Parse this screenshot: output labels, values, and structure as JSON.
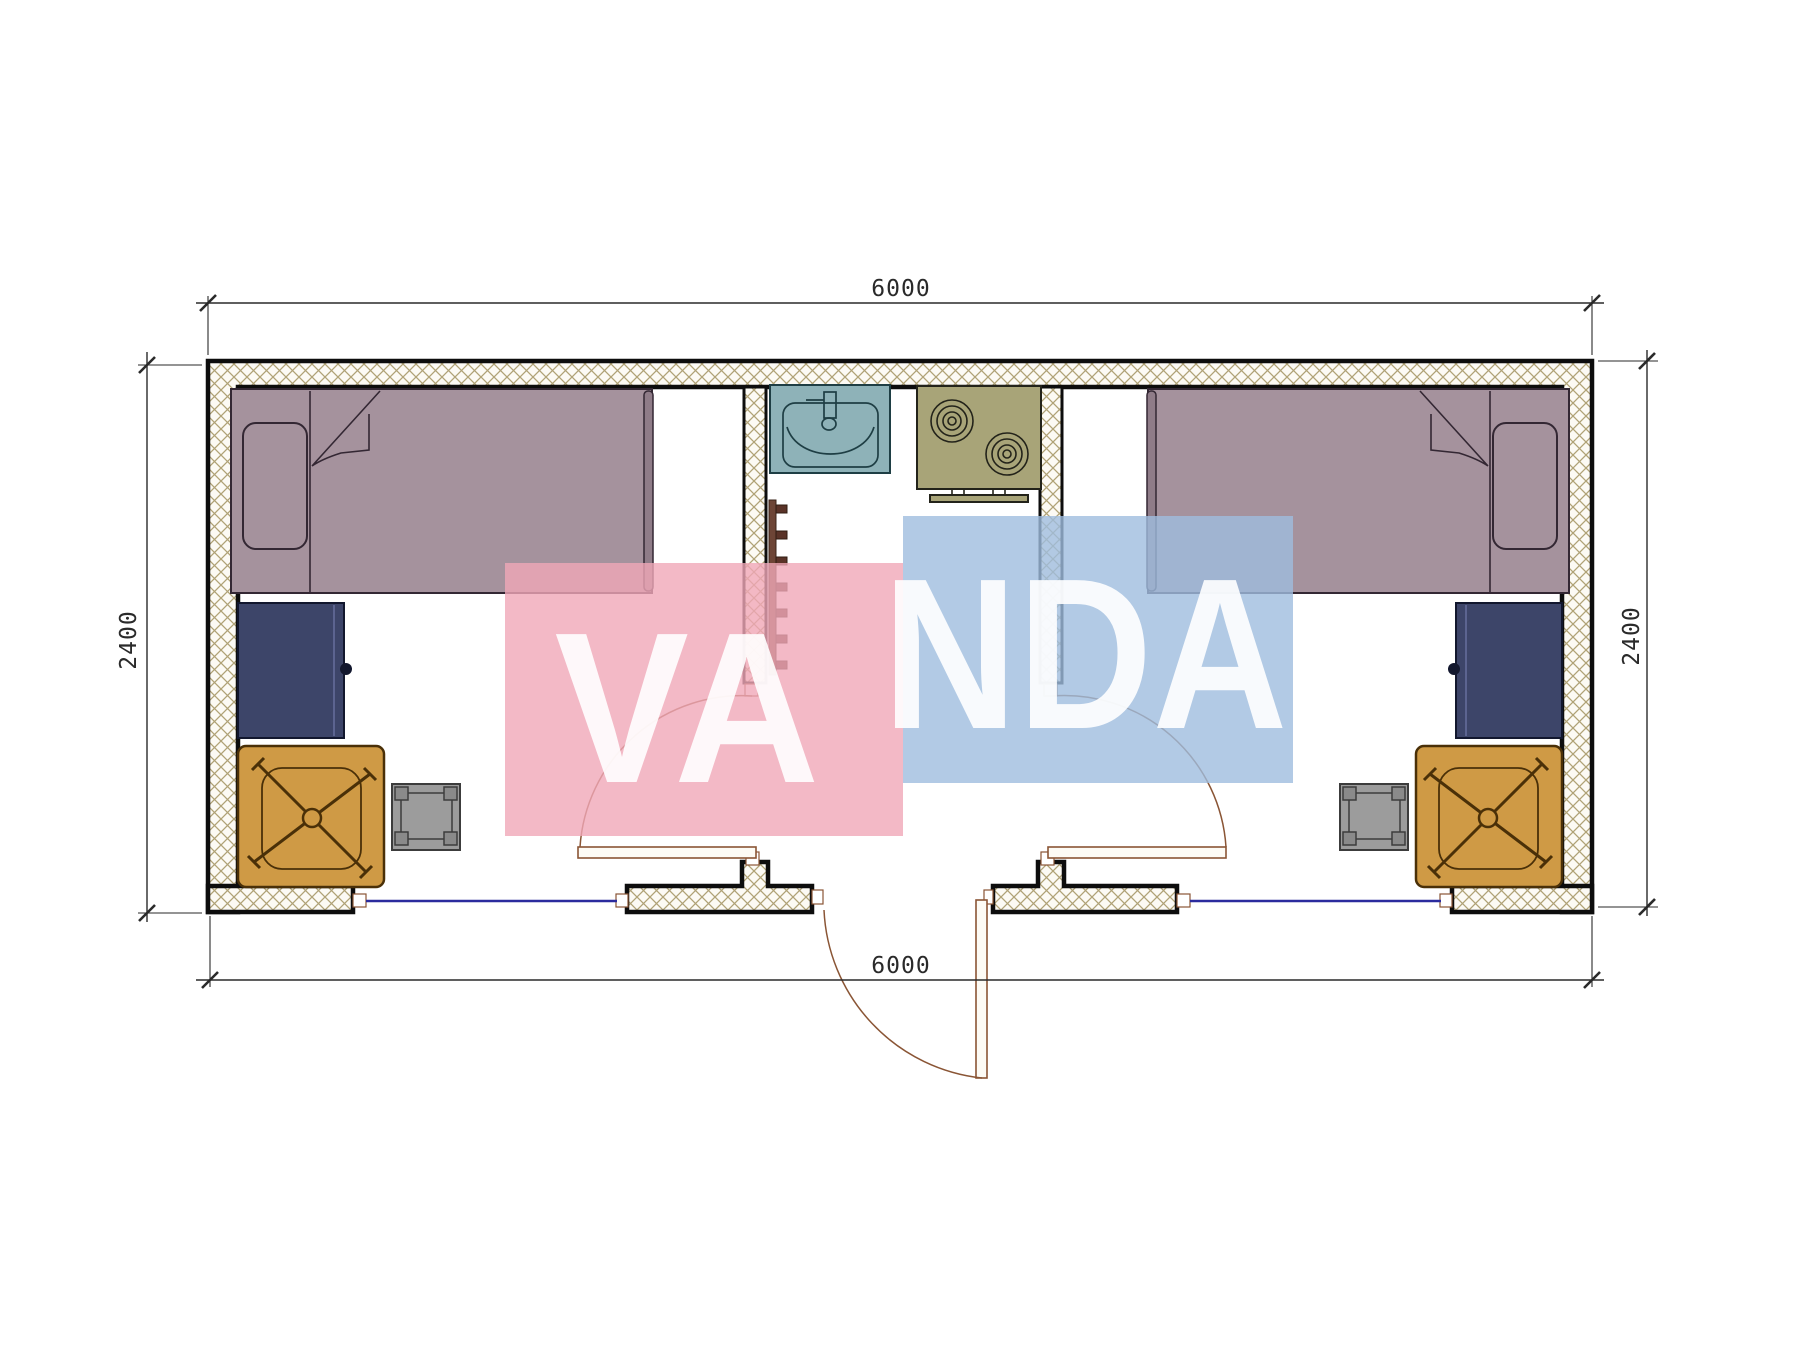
{
  "page": {
    "type": "architectural floor plan",
    "background": "#ffffff"
  },
  "dimensions": {
    "top": "6000",
    "bottom": "6000",
    "left": "2400",
    "right": "2400"
  },
  "watermark": {
    "line1": "VA",
    "line2": "NDA"
  },
  "colors": {
    "wall-line": "#0d0d0d",
    "hatch-line": "#b0a276",
    "hatch-bg": "#fcfaf4",
    "dim-line": "#2a2a2a",
    "bed-fill": "#a5929d",
    "footboard-fill": "#8f7c88",
    "bed-line": "#332733",
    "desk-fill": "#3d4569",
    "desk-line": "#12172e",
    "desk-edge": "#5c6490",
    "chair-fill": "#cf9a45",
    "chair-line": "#4a3008",
    "stool-fill": "#9c9c9c",
    "stool-leg": "#8a8a8a",
    "stool-line": "#3c3c3c",
    "sink-fill": "#8eb2b8",
    "sink-line": "#1e3e44",
    "stove-fill": "#a8a478",
    "stove-line": "#23231a",
    "door-line": "#8a5535",
    "door-leaf": "#fdfbf5",
    "window-line": "#2b2b9e",
    "ladder-rail": "#6d4536",
    "ladder-rung": "#5a3328",
    "watermark-pink": "#f0a8b8",
    "watermark-blue": "#9fbdde",
    "watermark-text": "#ffffff"
  },
  "furniture": {
    "left_room": [
      "single-bed",
      "pillow",
      "desk",
      "office-chair",
      "stool"
    ],
    "middle_room": [
      "sink",
      "stove",
      "ladder"
    ],
    "right_room": [
      "single-bed",
      "pillow",
      "desk",
      "office-chair",
      "stool"
    ]
  }
}
